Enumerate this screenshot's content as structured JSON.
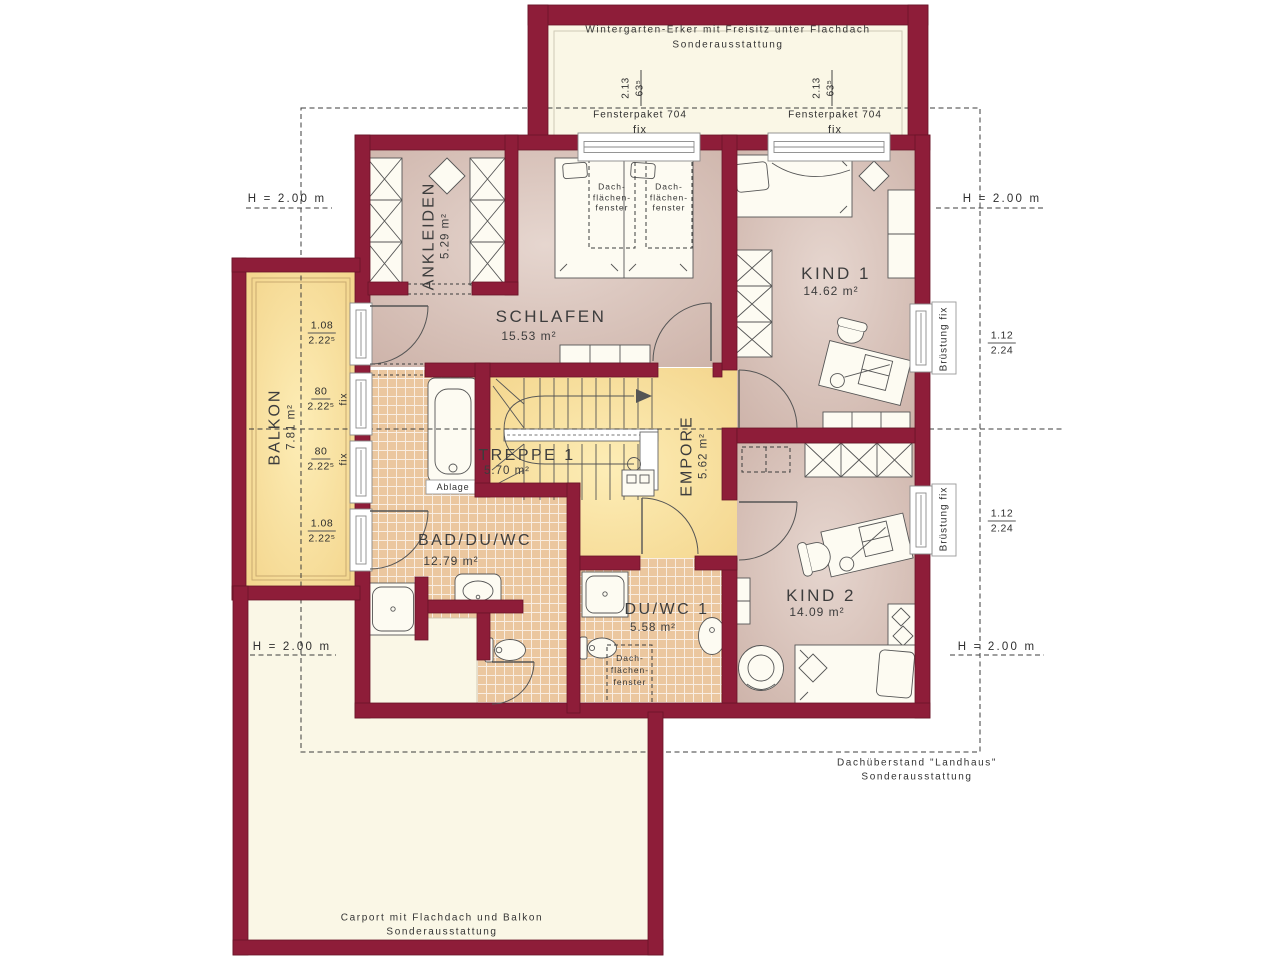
{
  "rooms": {
    "ankleiden": {
      "name": "ANKLEIDEN",
      "area": "5.29 m²"
    },
    "schlafen": {
      "name": "SCHLAFEN",
      "area": "15.53 m²"
    },
    "kind1": {
      "name": "KIND 1",
      "area": "14.62 m²"
    },
    "kind2": {
      "name": "KIND 2",
      "area": "14.09 m²"
    },
    "balkon": {
      "name": "BALKON",
      "area": "7.81 m²"
    },
    "treppe": {
      "name": "TREPPE 1",
      "area": "5.70 m²"
    },
    "empore": {
      "name": "EMPORE",
      "area": "5.62 m²"
    },
    "bad": {
      "name": "BAD/DU/WC",
      "area": "12.79 m²"
    },
    "duwc": {
      "name": "DU/WC 1",
      "area": "5.58 m²"
    }
  },
  "annotations": {
    "wintergarten_line1": "Wintergarten-Erker mit Freisitz unter Flachdach",
    "wintergarten_line2": "Sonderausstattung",
    "carport_line1": "Carport mit Flachdach und Balkon",
    "carport_line2": "Sonderausstattung",
    "dachueberstand_line1": "Dachüberstand \"Landhaus\"",
    "dachueberstand_line2": "Sonderausstattung",
    "height_marker": "H = 2.00 m",
    "bruestung_fix": "Brüstung fix",
    "fensterpaket_label": "Fensterpaket 704",
    "fensterpaket_width": "2.13",
    "fensterpaket_height": "63⁵",
    "fix": "fix",
    "ablage": "Ablage",
    "dachfenster_line1": "Dach-",
    "dachfenster_line2": "flächen-",
    "dachfenster_line3": "fenster"
  },
  "dimensions": {
    "right_upper": {
      "top": "1.12",
      "bottom": "2.24"
    },
    "right_lower": {
      "top": "1.12",
      "bottom": "2.24"
    },
    "balkon_1": {
      "top": "1.08",
      "bottom": "2.22⁵"
    },
    "balkon_2": {
      "top": "80",
      "bottom": "2.22⁵"
    },
    "balkon_3": {
      "top": "80",
      "bottom": "2.22⁵"
    },
    "balkon_4": {
      "top": "1.08",
      "bottom": "2.22⁵"
    }
  },
  "colors": {
    "wall": "#8e1d39",
    "floor_pink": "#d2b8ae",
    "floor_yellow": "#f5d88f",
    "tile": "#ebc79f",
    "cream": "#faf7e6"
  }
}
